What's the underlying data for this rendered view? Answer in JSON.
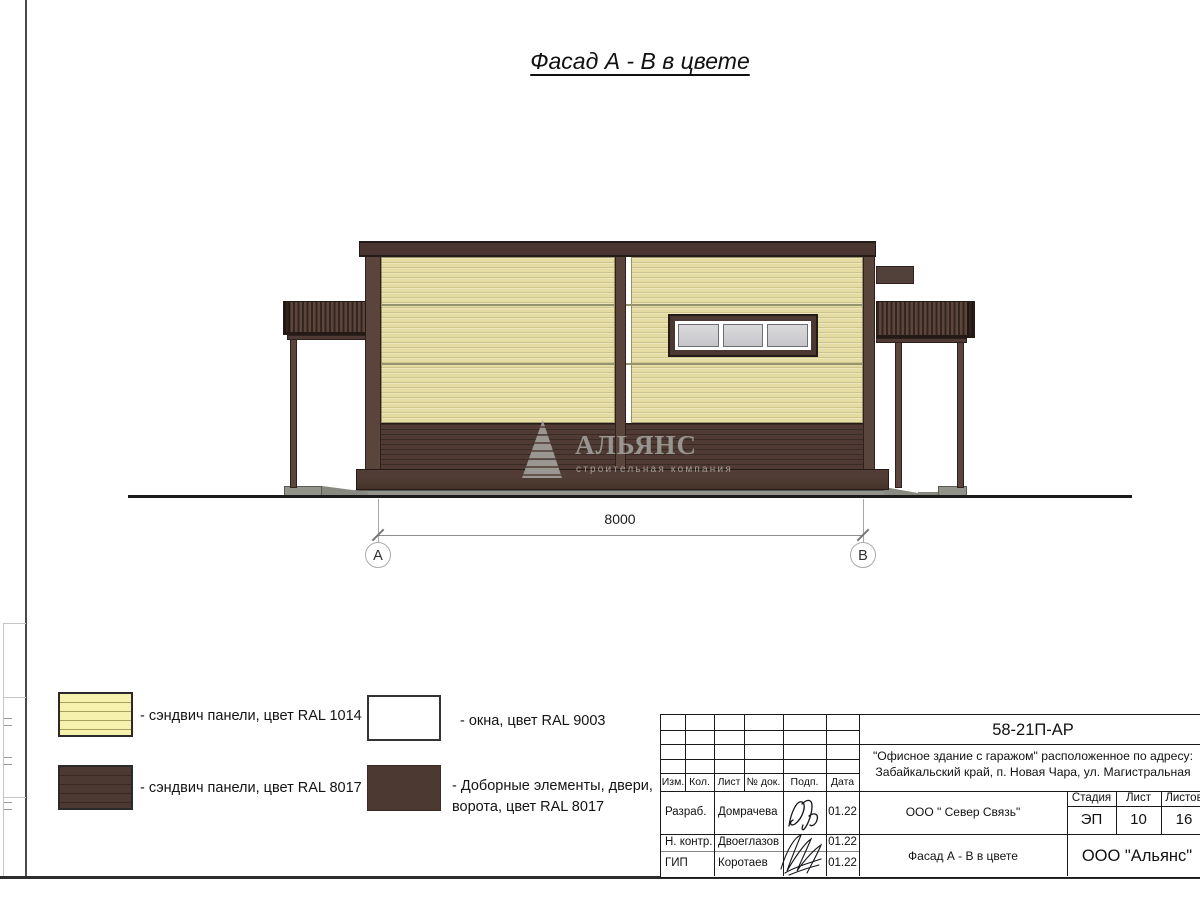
{
  "title": "Фасад А - В в цвете",
  "watermark": {
    "name": "АЛЬЯНС",
    "subtitle": "строительная компания"
  },
  "dimension": {
    "value": "8000",
    "axis_a": "А",
    "axis_b": "В"
  },
  "legend": [
    {
      "label": "- сэндвич панели, цвет RAL 1014",
      "swatch": "cream-striped-swatch"
    },
    {
      "label": "- сэндвич панели, цвет RAL 8017",
      "swatch": "brown-striped-swatch"
    },
    {
      "label": "- окна, цвет RAL 9003",
      "swatch": "white-swatch"
    },
    {
      "label": "- Доборные элементы, двери, ворота, цвет RAL 8017",
      "swatch": "brown-solid-swatch"
    }
  ],
  "title_block": {
    "doc_number": "58-21П-АР",
    "project_line1": "\"Офисное здание с гаражом\" расположенное по адресу:",
    "project_line2": "Забайкальский край, п. Новая Чара, ул. Магистральная",
    "columns": [
      "Изм.",
      "Кол.",
      "Лист",
      "№ док.",
      "Подп.",
      "Дата"
    ],
    "rows": [
      {
        "role": "Разраб.",
        "name": "Домрачева",
        "date": "01.22"
      },
      {
        "role": "Н. контр.",
        "name": "Двоеглазов",
        "date": "01.22"
      },
      {
        "role": "ГИП",
        "name": "Коротаев",
        "date": "01.22"
      }
    ],
    "client": "ООО \" Север Связь\"",
    "stage_label": "Стадия",
    "sheet_label": "Лист",
    "sheets_label": "Листов",
    "stage": "ЭП",
    "sheet": "10",
    "sheets": "16",
    "drawing_title": "Фасад А - В в цвете",
    "company": "ООО \"Альянс\""
  },
  "icons": {
    "pyramid_logo": "pyramid-logo-icon",
    "signature1": "signature-scribble",
    "signature2": "signature-scribble"
  },
  "colors": {
    "ral1014_wall": "#e5dca4",
    "ral8017_brown": "#4c3931",
    "ral9003_white": "#ffffff",
    "trim_brown": "#5a453c",
    "roof_brown": "#4a3631",
    "concrete_gray": "#92948c",
    "ground_line": "#1b1b1b"
  }
}
